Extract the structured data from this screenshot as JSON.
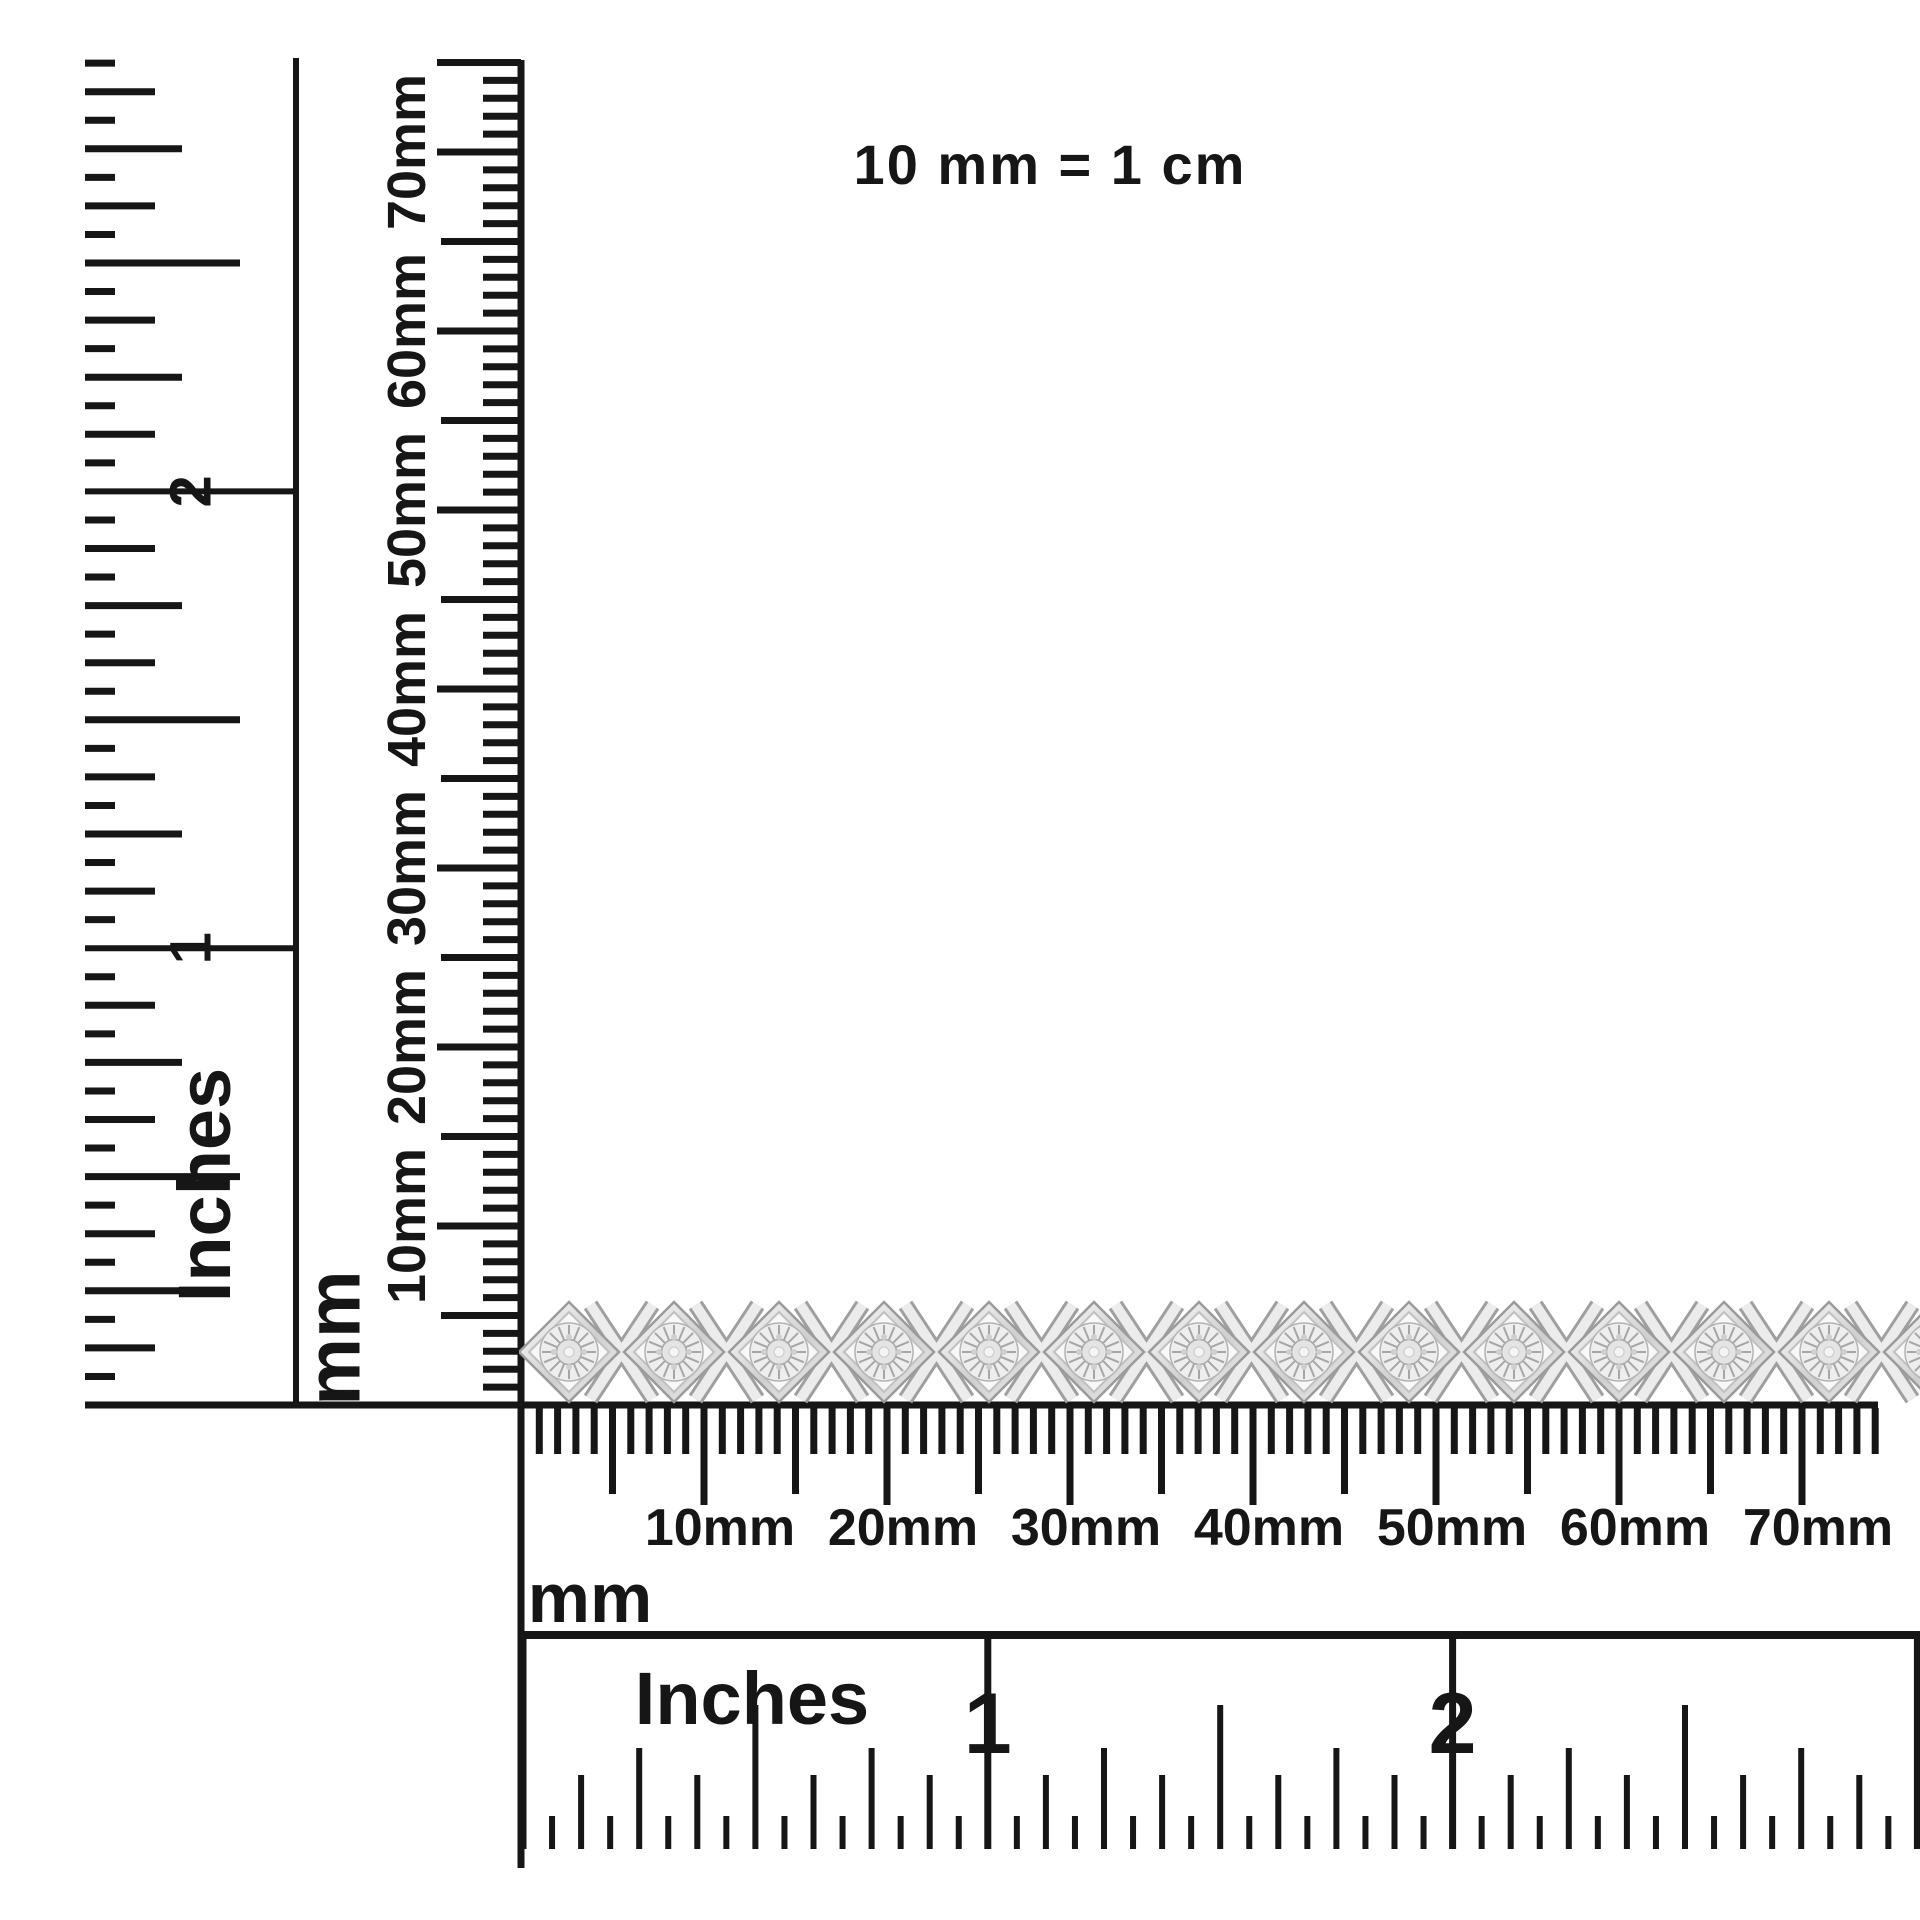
{
  "scale_note": {
    "text": "10 mm = 1 cm"
  },
  "vertical_inch_ruler": {
    "unit_label": "Inches",
    "numbers": [
      "1",
      "2"
    ]
  },
  "vertical_mm_ruler": {
    "unit_label": "mm",
    "labels": [
      "10mm",
      "20mm",
      "30mm",
      "40mm",
      "50mm",
      "60mm",
      "70mm"
    ]
  },
  "horizontal_mm_ruler": {
    "unit_label": "mm",
    "labels": [
      "10mm",
      "20mm",
      "30mm",
      "40mm",
      "50mm",
      "60mm",
      "70mm"
    ]
  },
  "horizontal_inch_ruler": {
    "unit_label": "Inches",
    "numbers": [
      "1",
      "2"
    ]
  },
  "bracelet": {
    "description": "silver diamond x-link tennis bracelet",
    "diamond_link_count": 14,
    "x_link_count": 14
  },
  "colors": {
    "ink": "#161616",
    "metal_edge": "#9b9b9b",
    "metal_mid": "#d6d6d6",
    "metal_light": "#f4f4f4",
    "stone": "#e4e4e4"
  }
}
